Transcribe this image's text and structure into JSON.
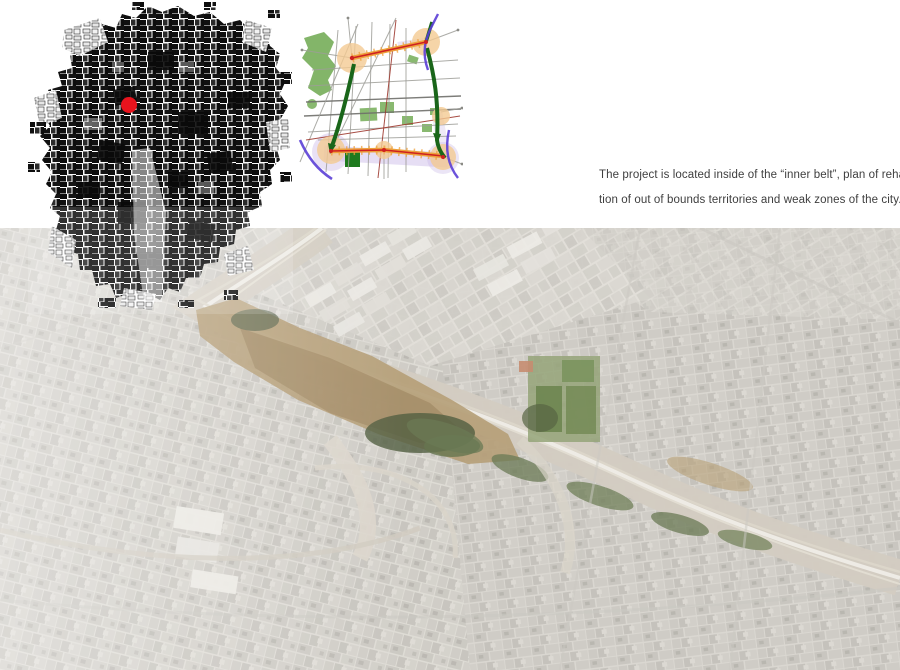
{
  "caption": {
    "lines": [
      "The project is located inside of the “inner belt”, plan of rehabilita-",
      "tion of out of bounds territories and weak zones of the city."
    ]
  },
  "colors": {
    "marker-red": "#e8131d",
    "park-green": "#7cb161",
    "park-dark-green": "#1e7a1e",
    "corridor-green": "#1a661a",
    "belt-orange": "#eda03b",
    "belt-red": "#cf2020",
    "node-orange": "#f4cb93",
    "river-purple": "#5b3fd6",
    "zone-lavender": "#c7b5e6"
  }
}
